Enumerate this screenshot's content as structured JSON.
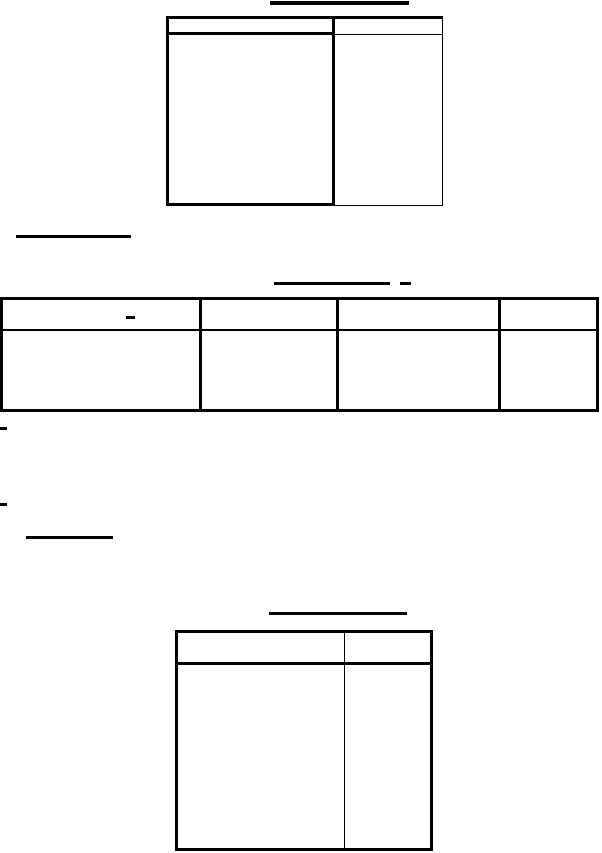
{
  "page": {
    "background_color": "#ffffff",
    "line_color": "#000000"
  },
  "tables": {
    "top_table": {
      "columns": 2,
      "header": [
        "",
        ""
      ],
      "body": [
        "",
        ""
      ]
    },
    "wide_table": {
      "columns": 4,
      "header": [
        "",
        "",
        "",
        ""
      ],
      "body": [
        "",
        "",
        "",
        ""
      ]
    },
    "bottom_table": {
      "columns": 2,
      "header": [
        "",
        ""
      ],
      "body": [
        "",
        ""
      ]
    }
  },
  "marks": {
    "title_underline": "rule",
    "left_underline": "rule",
    "center_underline": "rule",
    "center_underline_dash": "dash",
    "wide_table_header_dash": "dash",
    "margin_dash_1": "dash",
    "margin_dash_2": "dash",
    "small_underline": "rule",
    "bottom_title_underline": "rule"
  }
}
